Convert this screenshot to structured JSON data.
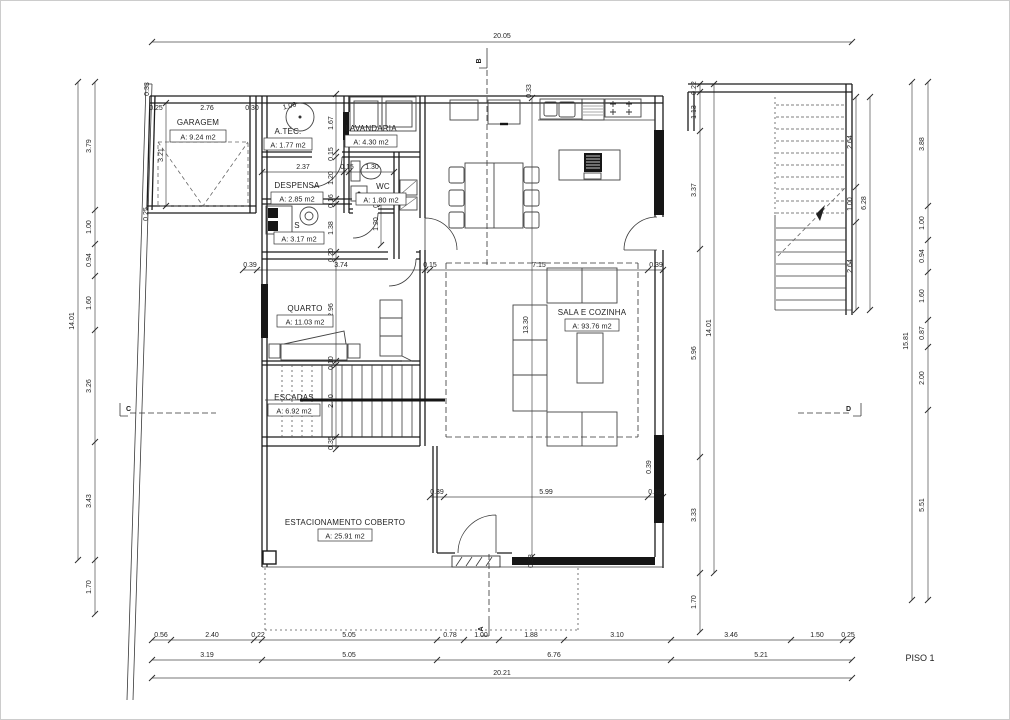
{
  "drawing": {
    "title": "PISO 1",
    "rooms": {
      "garagem": {
        "name": "GARAGEM",
        "area": "A: 9.24 m2"
      },
      "atec": {
        "name": "A.TÉC.",
        "area": "A: 1.77 m2"
      },
      "lavandaria": {
        "name": "LAVANDARIA",
        "area": "A: 4.30 m2"
      },
      "despensa": {
        "name": "DESPENSA",
        "area": "A: 2.85 m2"
      },
      "wc": {
        "name": "WC",
        "area": "A: 1.80 m2"
      },
      "s": {
        "name": "S",
        "area": "A: 3.17 m2"
      },
      "quarto": {
        "name": "QUARTO",
        "area": "A: 11.03 m2"
      },
      "escadas": {
        "name": "ESCADAS",
        "area": "A: 6.92 m2"
      },
      "sala": {
        "name": "SALA E COZINHA",
        "area": "A: 93.76 m2"
      },
      "estacionamento": {
        "name": "ESTACIONAMENTO COBERTO",
        "area": "A: 25.91 m2"
      }
    },
    "sections": {
      "a": "A",
      "b": "B",
      "c": "C",
      "d": "D"
    },
    "dims": {
      "top_total": "20.05",
      "bottom_total": "20.21",
      "left_total": "14.01",
      "right_total": "15.81",
      "right_inner_total": "14.01",
      "stair_total": "6.28",
      "left_chain": [
        "3.79",
        "1.00",
        "0.94",
        "1.60",
        "3.26",
        "3.43",
        "1.70"
      ],
      "right_chain": [
        "3.88",
        "1.00",
        "0.94",
        "1.60",
        "0.87",
        "2.00",
        "5.51"
      ],
      "right_inner_chain": [
        "0.22",
        "1.13",
        "3.37",
        "5.96",
        "3.33",
        "1.70"
      ],
      "stair_chain": [
        "2.64",
        "1.00",
        "2.64"
      ],
      "bottom_row1": [
        "0.56",
        "2.40",
        "0.22",
        "5.05",
        "0.78",
        "1.00",
        "1.88",
        "3.10",
        "3.46",
        "1.50",
        "0.25"
      ],
      "bottom_row2": [
        "3.19",
        "5.05",
        "6.76",
        "5.21"
      ],
      "top_edge": [
        "0.25",
        "2.76",
        "0.30",
        "1.06"
      ],
      "top_wall": [
        "0.33",
        "0.33"
      ],
      "garage": [
        "3.21",
        "0.25"
      ],
      "mid_row": [
        "0.39",
        "3.74",
        "0.15",
        "7.15",
        "0.39"
      ],
      "lower_row": [
        "0.39",
        "5.99",
        "0.39"
      ],
      "despensa_row": [
        "2.37",
        "0.15",
        "1.30"
      ],
      "interior_chain": [
        "1.67",
        "0.15",
        "1.20",
        "0.16",
        "1.38",
        "0.20",
        "2.96",
        "0.10",
        "2.10",
        "0.35"
      ],
      "wc_chain": [
        "0.15",
        "1.20"
      ],
      "sala_height": "13.30",
      "door_wall": "0.38",
      "glazing_wall": "0.39"
    }
  }
}
